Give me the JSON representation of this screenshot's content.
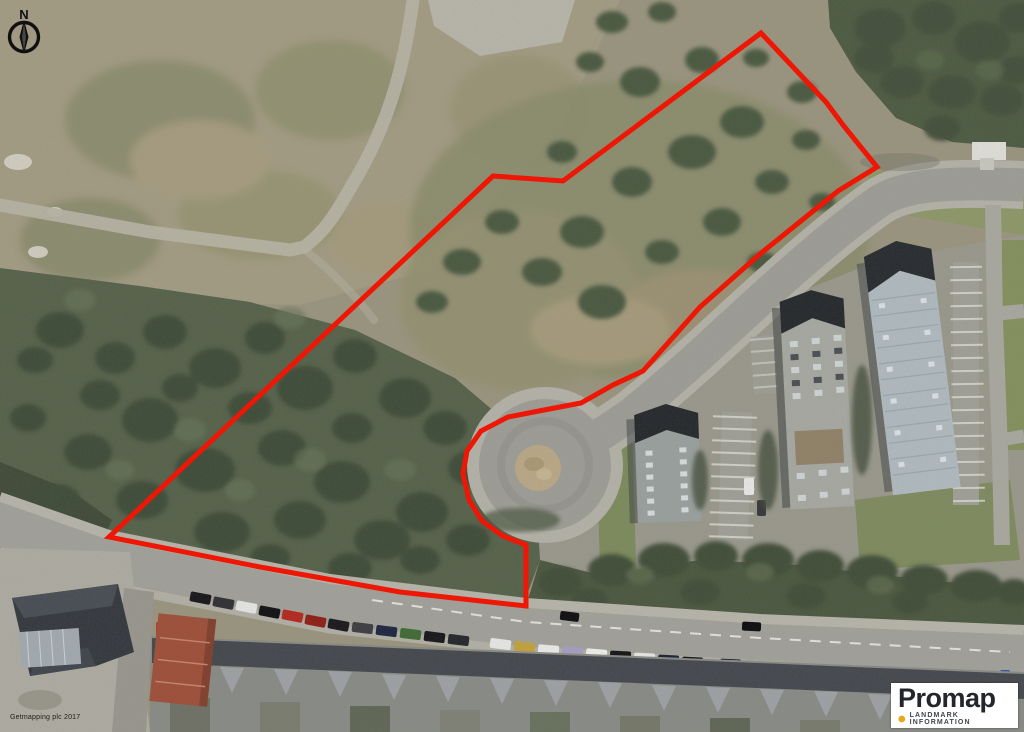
{
  "map": {
    "description": "Aerial photograph with red site boundary overlay",
    "attribution": "Getmapping plc 2017"
  },
  "compass": {
    "label": "N"
  },
  "boundary": {
    "color": "#ee1604",
    "stroke_width": 5,
    "points": "761,33 826,102 843,125 877,167 838,191 760,254 700,307 660,352 643,371 613,385 581,403 544,410 508,417 481,431 467,451 463,474 469,500 482,521 503,536 526,545 526,606 400,592 260,567 109,537 493,176 563,181"
  },
  "logo": {
    "brand": "Promap",
    "tagline": "LANDMARK INFORMATION",
    "dot_color": "#eaa61b"
  }
}
